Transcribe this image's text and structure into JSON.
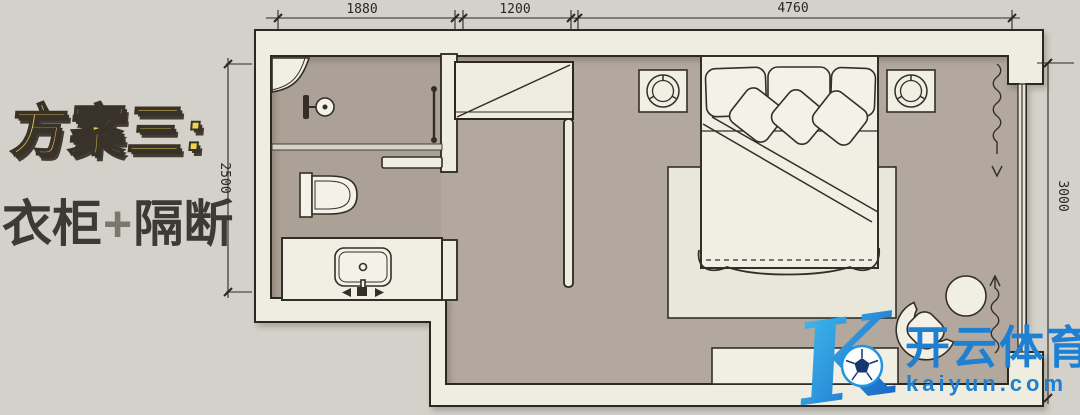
{
  "title": {
    "line1": "方案三:",
    "line2": {
      "prefix": "衣柜",
      "plus": "+",
      "suffix": "隔断"
    }
  },
  "dimensions": {
    "top": [
      {
        "label": "1880"
      },
      {
        "label": "1200"
      },
      {
        "label": "4760"
      }
    ],
    "left": {
      "label": "2500"
    },
    "right": {
      "label": "3000"
    }
  },
  "watermark": {
    "logo_letter": "K",
    "brand": "开云体育",
    "domain": "kaiyun.com"
  },
  "plan": {
    "rooms": [
      {
        "name": "bathroom"
      },
      {
        "name": "bedroom"
      }
    ],
    "fixtures": [
      "corner-shelf",
      "shower-head",
      "towel-rail",
      "glass-partition",
      "toilet",
      "wall-shelf",
      "vanity-sink",
      "wardrobe",
      "partition-wall",
      "ceiling-lamp-left",
      "ceiling-lamp-right",
      "double-bed",
      "pillows",
      "rug",
      "tv-bench",
      "armchair",
      "side-table",
      "window",
      "curtain-top",
      "curtain-bottom"
    ]
  },
  "colors": {
    "background": "#d4d1ca",
    "floor": "#b2a89e",
    "bathroom_floor": "#aba196",
    "wall_fill": "#efece0",
    "wall_line": "#2b2721",
    "rug": "#e9e6da",
    "furniture_fill": "#f1eee3",
    "title_yellow": "#f2d24e",
    "title_outline": "#39322a",
    "subtitle_dark": "#3b3a35",
    "plus_gray": "#7a776e",
    "dim_line": "#2b2721",
    "watermark_blue": "#1d80d2",
    "logo_gradient_start": "#45c8f5",
    "logo_gradient_end": "#1158be"
  }
}
